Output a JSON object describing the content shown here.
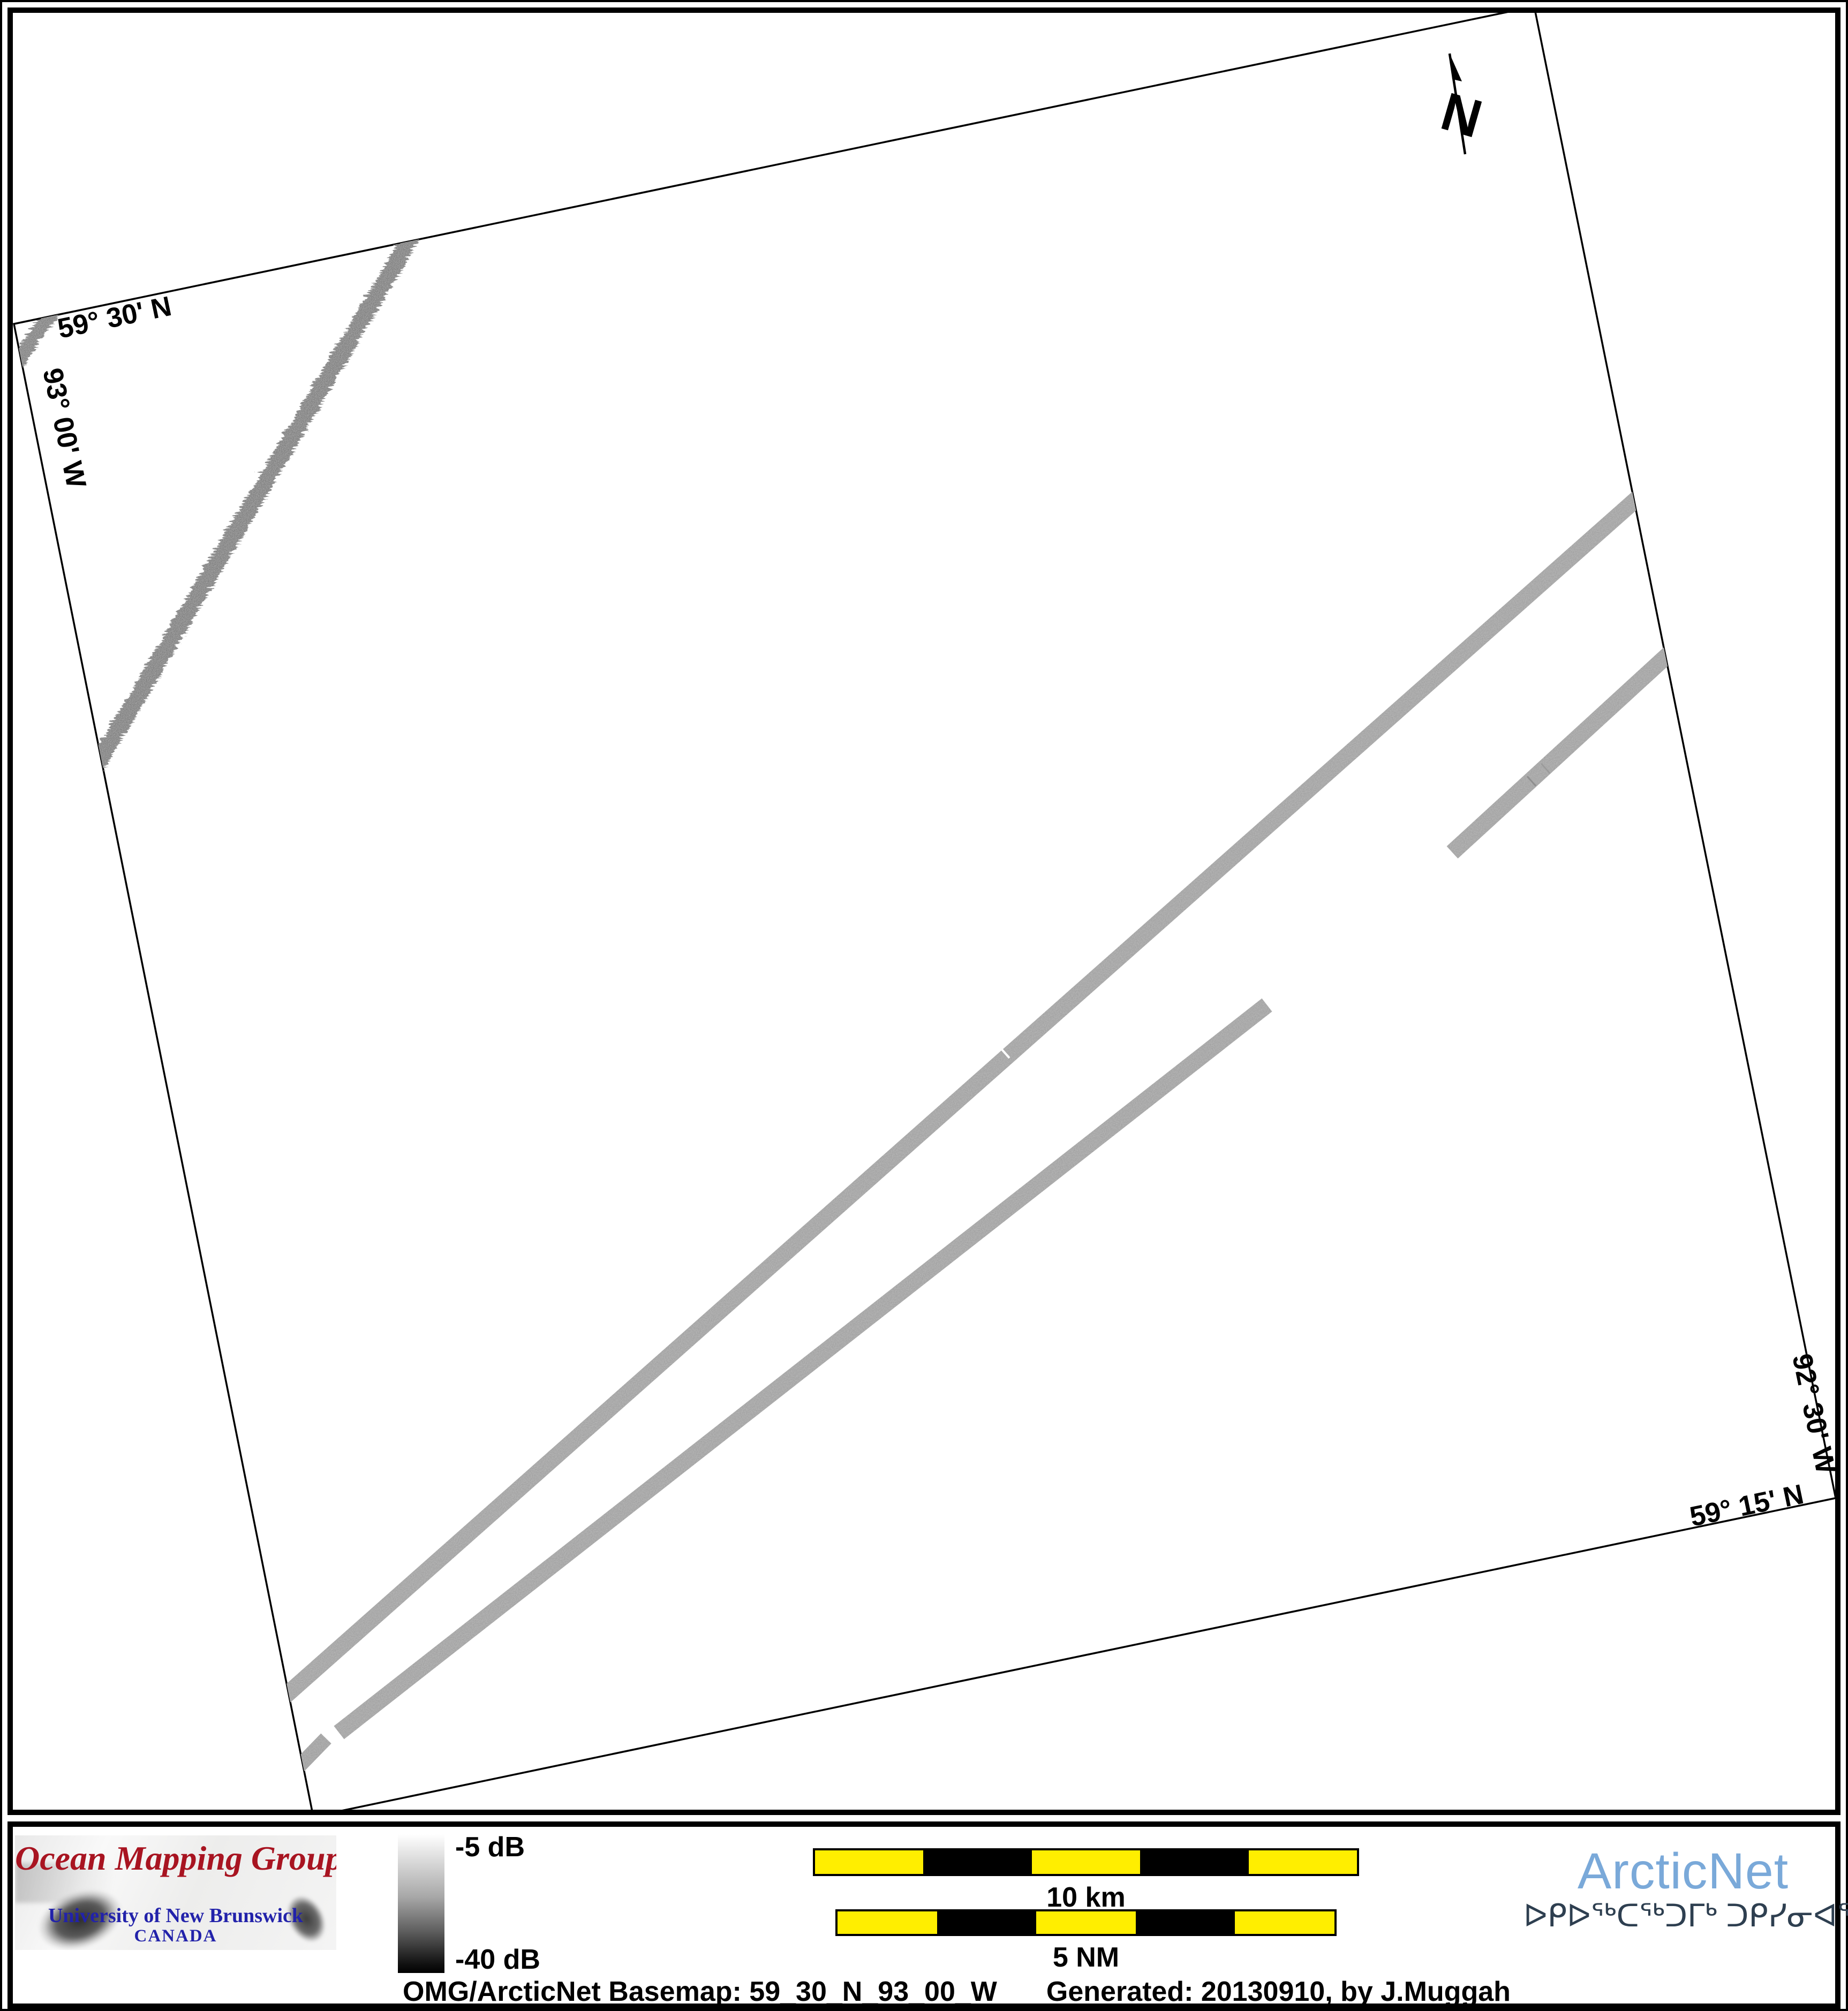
{
  "map": {
    "north_label": "N",
    "graticule": {
      "top_latitude": "59° 30' N",
      "left_longitude": "93° 00' W",
      "right_longitude": "92° 30' W",
      "bottom_latitude": "59° 15' N"
    },
    "features": "grayscale multibeam sonar backscatter survey swaths on white basemap, map frame rotated ~11.5 degrees"
  },
  "colorbar": {
    "top_label": "-5 dB",
    "bottom_label": "-40 dB"
  },
  "scale_bars": {
    "bars": [
      {
        "label": "10 km",
        "segment_pattern": [
          "yellow",
          "black",
          "yellow",
          "black",
          "yellow"
        ]
      },
      {
        "label": "5 NM",
        "segment_pattern": [
          "yellow",
          "black",
          "yellow",
          "black",
          "yellow"
        ]
      }
    ]
  },
  "omg_logo": {
    "title": "Ocean Mapping Group",
    "institution": "University of New Brunswick",
    "country": "CANADA"
  },
  "arcticnet_logo": {
    "name": "ArcticNet",
    "inuktitut": "ᐅᑭᐅᖅᑕᖅᑐᒥᒃ ᑐᑭᓯᓂᐊᖅᑎᒌᑦ"
  },
  "caption": {
    "basemap": "OMG/ArcticNet Basemap: 59_30_N_93_00_W",
    "generated": "Generated: 20130910, by J.Muggah"
  },
  "colors": {
    "omg_red": "#a81421",
    "unb_blue": "#2222aa",
    "arcticnet_blue": "#7aa9d9",
    "inuktitut_navy": "#2e3f50",
    "scalebar_yellow": "#ffee00",
    "swath_gray": "#b7b7b7"
  }
}
